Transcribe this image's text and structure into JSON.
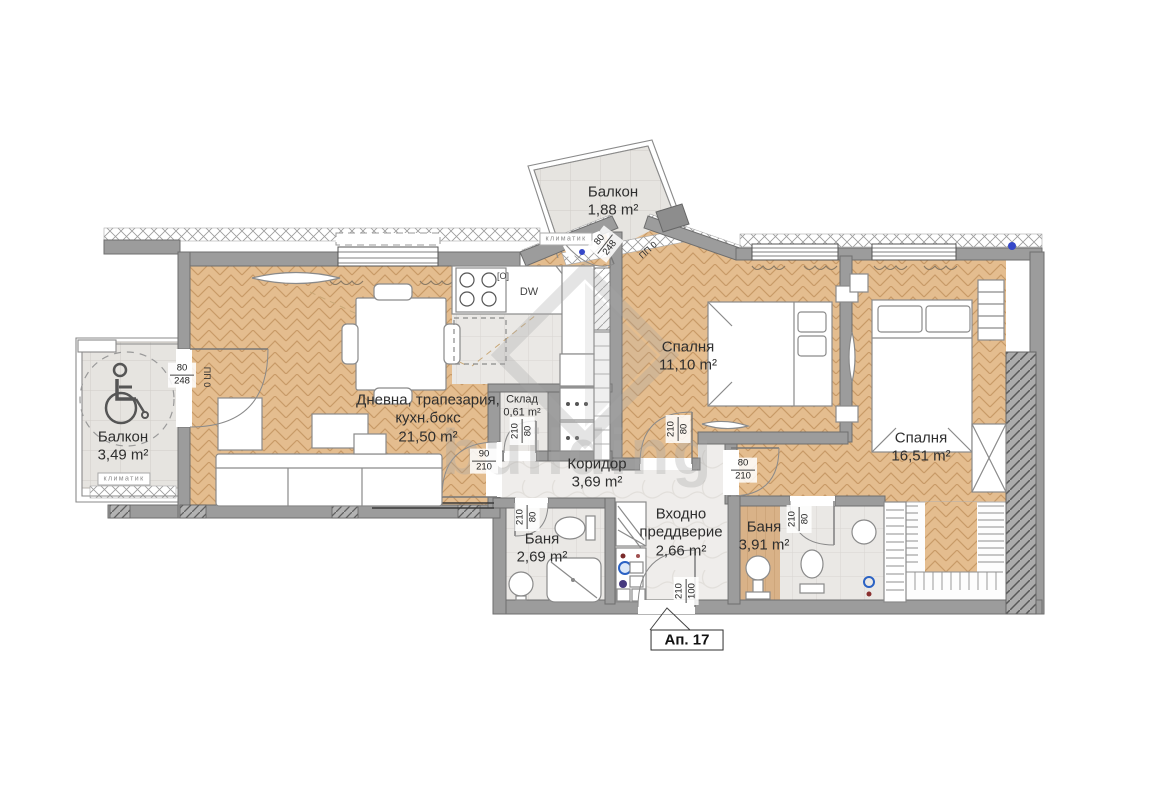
{
  "plan": {
    "watermark": "building",
    "apartment": {
      "label": "Ап. 17"
    },
    "rooms": {
      "balcony_top": {
        "name": "Балкон",
        "area": "1,88 m²"
      },
      "balcony_left": {
        "name": "Балкон",
        "area": "3,49 m²"
      },
      "living": {
        "name_line1": "Дневна, трапезария,",
        "name_line2": "кухн.бокс",
        "area": "21,50 m²"
      },
      "storage": {
        "name": "Склад",
        "area": "0,61 m²"
      },
      "corridor": {
        "name": "Коридор",
        "area": "3,69 m²"
      },
      "entry": {
        "name_line1": "Входно",
        "name_line2": "преддверие",
        "area": "2,66 m²"
      },
      "bath1": {
        "name": "Баня",
        "area": "2,69 m²"
      },
      "bath2": {
        "name": "Баня",
        "area": "3,91 m²"
      },
      "bedroom1": {
        "name": "Спалня",
        "area": "11,10 m²"
      },
      "bedroom2": {
        "name": "Спалня",
        "area": "16,51 m²"
      }
    },
    "annotations": {
      "klimatik": "климатик",
      "pp0": "ПП 0",
      "dishwasher": "DW",
      "oven_symbol": "[O]"
    },
    "doors": {
      "balcony_top": {
        "w": "80",
        "h": "248"
      },
      "balcony_left": {
        "w": "80",
        "h": "248"
      },
      "living": {
        "w": "90",
        "h": "210"
      },
      "storage": {
        "w": "80",
        "h": "210"
      },
      "bedroom1": {
        "w": "80",
        "h": "210"
      },
      "bedroom2": {
        "w": "80",
        "h": "210"
      },
      "bath1": {
        "w": "80",
        "h": "210"
      },
      "bath2": {
        "w": "80",
        "h": "210"
      },
      "entry": {
        "w": "100",
        "h": "210"
      }
    },
    "colors": {
      "parquet": "#e4bd8f",
      "tile": "#eae8e5",
      "wall": "#9c9c9c",
      "marker_blue": "#3547c8"
    }
  }
}
